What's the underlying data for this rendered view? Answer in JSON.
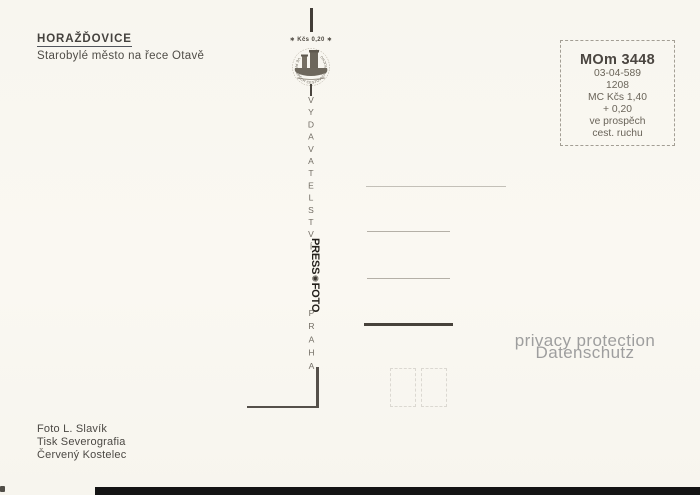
{
  "card": {
    "title": "HORAŽĎOVICE",
    "subtitle": "Starobylé město na řece Otavě",
    "emblem": {
      "value_line": "∗ Kčs 0,20 ∗",
      "ring_text": "VE PROSPĚCH CESTOVNÍHO RUCHU"
    },
    "spine": {
      "publisher": "VYDAVATELSTVÍ",
      "logo_press": "PRESS",
      "logo_emblem_glyph": "✺",
      "logo_foto": "FOTO",
      "city": "PRAHA"
    },
    "stamp_box": {
      "code": "MOm 3448",
      "lines": [
        "03-04-589",
        "1208",
        "MC Kčs 1,40",
        "+ 0,20",
        "ve prospěch",
        "cest. ruchu"
      ]
    },
    "watermark": {
      "line1": "privacy protection",
      "line2": "Datenschutz"
    },
    "credits": {
      "photo": "Foto L. Slavík",
      "print": "Tisk Severografia",
      "city": "Červený Kostelec"
    },
    "colors": {
      "paper": "#faf8f2",
      "ink": "#45423e",
      "ink_soft": "#6a6459",
      "line_light": "#c3c0b8",
      "line_dark": "#47423b",
      "watermark": "#9e9e9e",
      "edge": "#141414"
    }
  }
}
